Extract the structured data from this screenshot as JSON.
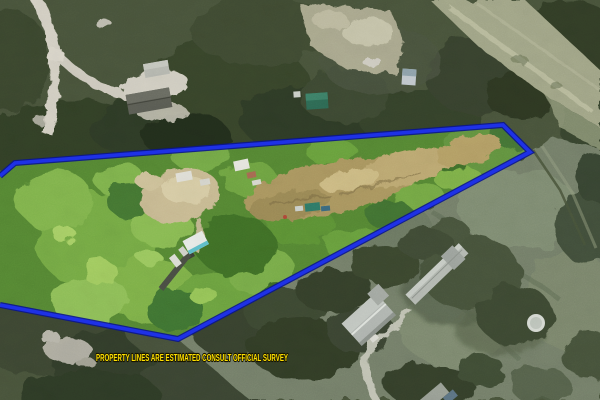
{
  "annotation": {
    "disclaimer_text": "PROPERTY LINES ARE ESTIMATED CONSULT OFFICIAL SURVEY",
    "disclaimer_color": "#FFE000",
    "boundary_color": "#1E31E6",
    "boundary_outline_color": "#0A1590",
    "boundary_points": "0,176 15,163 503,125 530,152 178,339 0,305",
    "boundary_vertices": [
      [
        0,
        176
      ],
      [
        15,
        163
      ],
      [
        503,
        125
      ],
      [
        530,
        152
      ],
      [
        178,
        339
      ],
      [
        0,
        305
      ]
    ]
  }
}
